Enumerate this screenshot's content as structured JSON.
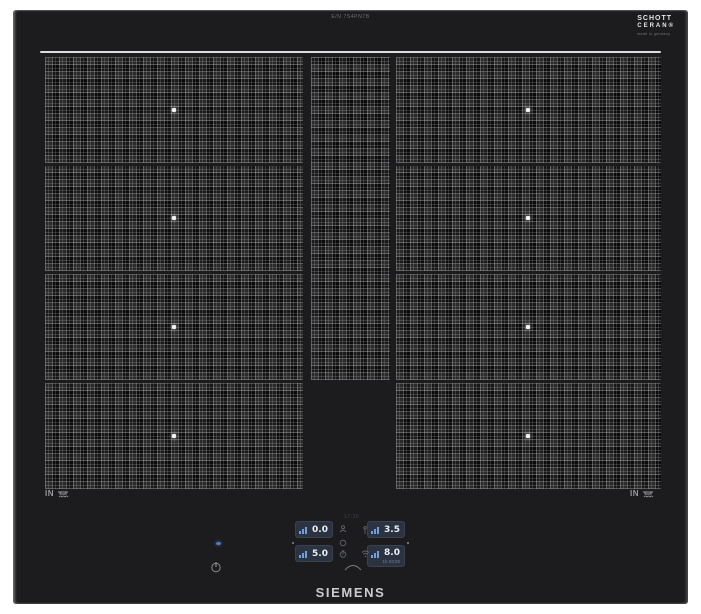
{
  "product": {
    "brand": "SIEMENS",
    "model_text": "E/N 7S4PN7B",
    "glass_logo": {
      "line1": "SCHOTT",
      "line2": "CERAN®",
      "line3": "made in germany"
    },
    "induction_label_left": "IN",
    "induction_label_right": "IN"
  },
  "control_panel": {
    "clock": "17:30",
    "zones": [
      {
        "id": "rear-left",
        "level": "0.0"
      },
      {
        "id": "front-left",
        "level": "5.0"
      },
      {
        "id": "rear-right",
        "level": "3.5"
      },
      {
        "id": "front-right",
        "level": "8.0",
        "timer": "1h 03:25"
      }
    ],
    "colors": {
      "display_bg": "#2b3240",
      "display_text": "#e9eef6",
      "bars_accent": "#6f9fdd",
      "led_blue": "#4d7fc9",
      "surface_black": "#1c1c1e"
    }
  }
}
